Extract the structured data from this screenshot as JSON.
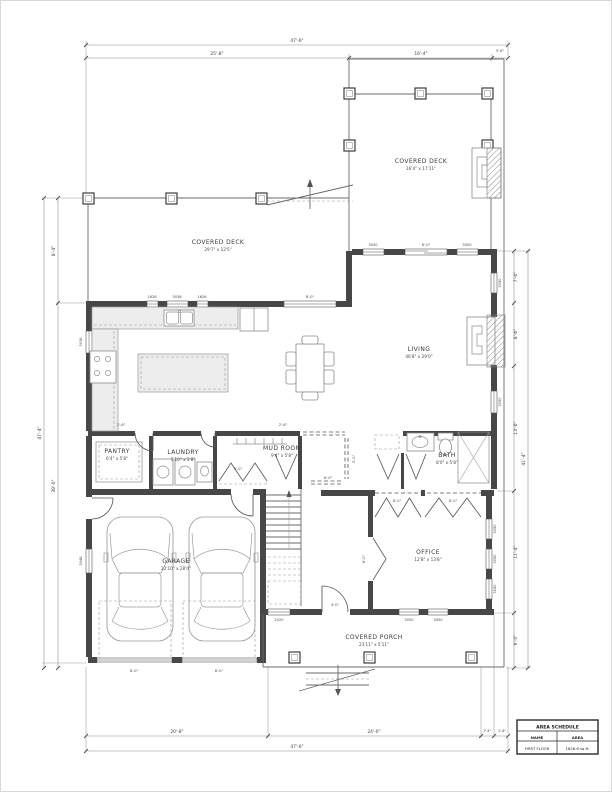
{
  "rooms": [
    {
      "name": "COVERED DECK",
      "dims": "16'4\" x 17'11\""
    },
    {
      "name": "COVERED DECK",
      "dims": "29'7\" x 12'5\""
    },
    {
      "name": "LIVING",
      "dims": "46'8\" x 29'0\""
    },
    {
      "name": "PANTRY",
      "dims": "6'4\" x 5'8\""
    },
    {
      "name": "LAUNDRY",
      "dims": "5'10\" x 5'8\""
    },
    {
      "name": "MUD ROOM",
      "dims": "9'4\" x 5'8\""
    },
    {
      "name": "BATH",
      "dims": "8'0\" x 5'8\""
    },
    {
      "name": "GARAGE",
      "dims": "22'10\" x 28'0\""
    },
    {
      "name": "OFFICE",
      "dims": "12'8\" x 13'8\""
    },
    {
      "name": "COVERED PORCH",
      "dims": "23'11\" x 5'11\""
    }
  ],
  "dims": {
    "top_overall": "47'-6\"",
    "top_left": "25'-8\"",
    "top_mid": "16'-4\"",
    "top_right": "5'-6\"",
    "bottom_seg1": "20'-8\"",
    "bottom_seg2": "24'-0\"",
    "bottom_seg3": "1'-4\"",
    "bottom_seg4": "1'-6\"",
    "bottom_overall": "47'-6\"",
    "left_seg1": "8'-4\"",
    "left_seg2": "39'-0\"",
    "left_overall": "47'-4\"",
    "right_seg1": "7'-6\"",
    "right_seg2": "8'-6\"",
    "right_seg3": "13'-6\"",
    "right_seg4": "11'-4\"",
    "right_seg5": "6'-0\"",
    "right_overall": "41'-4\""
  },
  "openings": {
    "kit_win1": "1626",
    "kit_win2": "3036",
    "kit_win3": "1626",
    "kit_win4": "8'-0\"",
    "liv_win1": "3050",
    "liv_door": "6'-0\"",
    "liv_win2": "3050",
    "right_win1": "3050",
    "right_win2": "3050",
    "left_win1": "3036",
    "left_win2": "3048",
    "off_win1": "3050",
    "off_win2": "3050",
    "off_win3": "3050",
    "off_win4": "3050",
    "off_win5": "3050",
    "porch_win": "2020",
    "front_door": "3'-0\"",
    "gar_door1": "8'-0\"",
    "gar_door2": "8'-0\""
  },
  "interior": {
    "counter1": "2'-6\"",
    "counter2": "2'-6\"",
    "closet": "9'-0\"",
    "hall_open": "6'-0\"",
    "hall_case": "3'-0\"",
    "off_open1": "8'-0\"",
    "off_open2": "8'-0\"",
    "off_door": "6'-0\""
  },
  "schedule": {
    "title": "AREA SCHEDULE",
    "col_name": "NAME",
    "col_area": "AREA",
    "row_name": "FIRST FLOOR",
    "row_area": "1628.6 sq ft."
  },
  "colors": {
    "wall": "#474747",
    "counter": "#ededed",
    "line": "#6b6b6b"
  }
}
